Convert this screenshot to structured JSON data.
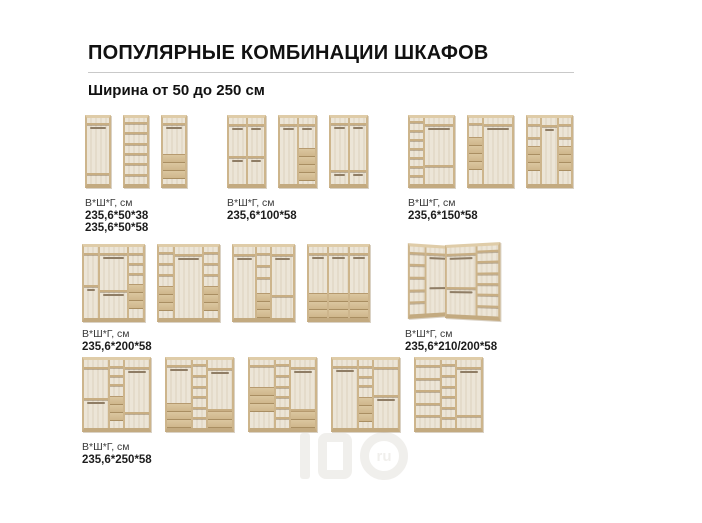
{
  "page": {
    "title": "ПОПУЛЯРНЫЕ КОМБИНАЦИИ ШКАФОВ",
    "subtitle": "Ширина от 50 до 250 см"
  },
  "dims_label": "В*Ш*Г, см",
  "watermark": {
    "circle_label": "ru"
  },
  "colors": {
    "wood_frame": "#cdb58c",
    "wood_top": "#dfcca8",
    "wood_plinth": "#c3aa80",
    "interior": "#ece5d7",
    "shelf": "#c8ae83",
    "rod": "#8f7d65",
    "drawer": "#d5bf97",
    "text": "#1d1d1d",
    "rule": "#c9c9c9"
  },
  "groups": [
    {
      "key": "width-50",
      "dims": [
        "235,6*50*38",
        "235,6*50*58"
      ],
      "wardrobes": [
        {
          "w": 26,
          "h": 73,
          "cols": [
            {
              "f": 1,
              "items": [
                "o:0.35",
                "s",
                "r",
                "o:3",
                "s",
                "o:0.6"
              ]
            }
          ]
        },
        {
          "w": 26,
          "h": 73,
          "cols": [
            {
              "f": 1,
              "items": [
                "sh:6"
              ]
            }
          ]
        },
        {
          "w": 26,
          "h": 73,
          "cols": [
            {
              "f": 1,
              "items": [
                "o:0.35",
                "s",
                "r",
                "o:2",
                "d:3",
                "o:0.35"
              ]
            }
          ]
        }
      ]
    },
    {
      "key": "width-100",
      "dims": [
        "235,6*100*58"
      ],
      "wardrobes": [
        {
          "w": 39,
          "h": 73,
          "cols": [
            {
              "f": 1,
              "items": [
                "o:0.35",
                "s",
                "r",
                "o:1.6",
                "s",
                "r",
                "o:1.3"
              ]
            },
            {
              "f": 1,
              "items": [
                "o:0.35",
                "s",
                "r",
                "o:1.6",
                "s",
                "r",
                "o:1.3"
              ]
            }
          ]
        },
        {
          "w": 39,
          "h": 73,
          "cols": [
            {
              "f": 1,
              "items": [
                "o:0.35",
                "s",
                "r",
                "o:3"
              ]
            },
            {
              "f": 1,
              "items": [
                "o:0.35",
                "s",
                "r",
                "o:1",
                "d:4",
                "o:0.2"
              ]
            }
          ]
        },
        {
          "w": 39,
          "h": 73,
          "cols": [
            {
              "f": 1,
              "items": [
                "o:0.35",
                "s",
                "r",
                "o:2.6",
                "s",
                "r",
                "o:0.5"
              ]
            },
            {
              "f": 1,
              "items": [
                "o:0.35",
                "s",
                "r",
                "o:2.6",
                "s",
                "r",
                "o:0.5"
              ]
            }
          ]
        }
      ]
    },
    {
      "key": "width-150",
      "dims": [
        "235,6*150*58"
      ],
      "wardrobes": [
        {
          "w": 47,
          "h": 73,
          "cols": [
            {
              "f": 1,
              "items": [
                "sh:7"
              ]
            },
            {
              "f": 2.1,
              "items": [
                "o:0.35",
                "s",
                "r",
                "o:2",
                "s",
                "o:1"
              ]
            }
          ]
        },
        {
          "w": 47,
          "h": 73,
          "cols": [
            {
              "f": 1,
              "items": [
                "o:0.35",
                "s",
                "o:0.8",
                "d:4",
                "o:1"
              ]
            },
            {
              "f": 2.1,
              "items": [
                "o:0.35",
                "s",
                "r",
                "o:3"
              ]
            }
          ]
        },
        {
          "w": 47,
          "h": 73,
          "cols": [
            {
              "f": 1,
              "items": [
                "o:0.3",
                "s",
                "o:0.6",
                "s",
                "o:0.4",
                "d:3",
                "o:0.7"
              ]
            },
            {
              "f": 1.15,
              "items": [
                "o:0.35",
                "s",
                "r",
                "o:2.6"
              ]
            },
            {
              "f": 1,
              "items": [
                "o:0.3",
                "s",
                "o:0.6",
                "s",
                "o:0.4",
                "d:3",
                "o:0.7"
              ]
            }
          ]
        }
      ]
    },
    {
      "key": "width-200",
      "dims": [
        "235,6*200*58"
      ],
      "wardrobes": [
        {
          "w": 63,
          "h": 78,
          "cols": [
            {
              "f": 1,
              "items": [
                "o:0.3",
                "s",
                "o:1.4",
                "s",
                "r",
                "o:1.3"
              ]
            },
            {
              "f": 2,
              "items": [
                "o:0.3",
                "s",
                "r",
                "o:1.5",
                "s",
                "r",
                "o:1.1"
              ]
            },
            {
              "f": 1,
              "items": [
                "o:0.3",
                "s",
                "o:0.45",
                "s",
                "o:0.45",
                "s",
                "o:0.45",
                "d:3",
                "o:0.5"
              ]
            }
          ]
        },
        {
          "w": 63,
          "h": 78,
          "cols": [
            {
              "f": 1,
              "items": [
                "o:0.3",
                "s",
                "o:0.5",
                "s",
                "o:0.5",
                "s",
                "o:0.6",
                "d:3",
                "o:0.4"
              ]
            },
            {
              "f": 2,
              "items": [
                "o:0.3",
                "s",
                "r",
                "o:2.4"
              ]
            },
            {
              "f": 1,
              "items": [
                "o:0.3",
                "s",
                "o:0.5",
                "s",
                "o:0.5",
                "s",
                "o:0.6",
                "d:3",
                "o:0.4"
              ]
            }
          ]
        },
        {
          "w": 63,
          "h": 78,
          "cols": [
            {
              "f": 1.6,
              "items": [
                "o:0.3",
                "s",
                "r",
                "o:2.5"
              ]
            },
            {
              "f": 1,
              "items": [
                "o:0.3",
                "s",
                "o:0.5",
                "s",
                "o:0.5",
                "s",
                "o:0.7",
                "d:3"
              ]
            },
            {
              "f": 1.6,
              "items": [
                "o:0.3",
                "s",
                "r",
                "o:1.5",
                "s",
                "o:0.9"
              ]
            }
          ]
        },
        {
          "w": 63,
          "h": 78,
          "cols": [
            {
              "f": 1,
              "items": [
                "o:0.3",
                "s",
                "r",
                "o:1.8",
                "d:3"
              ]
            },
            {
              "f": 1,
              "items": [
                "o:0.3",
                "s",
                "r",
                "o:1.8",
                "d:3"
              ]
            },
            {
              "f": 1,
              "items": [
                "o:0.3",
                "s",
                "r",
                "o:1.8",
                "d:3"
              ]
            }
          ]
        }
      ]
    },
    {
      "key": "width-210-200-corner",
      "dims": [
        "235,6*210/200*58"
      ],
      "corner_wings": [
        {
          "w": 46,
          "h": 70,
          "cols": [
            {
              "f": 1,
              "items": [
                "sh:5"
              ]
            },
            {
              "f": 1.6,
              "items": [
                "o:0.3",
                "s",
                "r",
                "o:1.5",
                "r",
                "o:1.4"
              ]
            }
          ]
        },
        {
          "w": 56,
          "h": 73,
          "cols": [
            {
              "f": 1.5,
              "items": [
                "o:0.3",
                "s",
                "r",
                "o:1.3",
                "s",
                "r",
                "o:1"
              ]
            },
            {
              "f": 1,
              "items": [
                "sh:6"
              ]
            }
          ]
        }
      ]
    },
    {
      "key": "width-250",
      "dims": [
        "235,6*250*58"
      ],
      "wardrobes": [
        {
          "w": 69,
          "h": 75,
          "cols": [
            {
              "f": 1.8,
              "items": [
                "o:0.3",
                "s",
                "o:1.3",
                "s",
                "r",
                "o:1.1"
              ]
            },
            {
              "f": 1,
              "items": [
                "o:0.3",
                "s",
                "o:0.4",
                "s",
                "o:0.4",
                "s",
                "o:0.5",
                "d:3",
                "o:0.4"
              ]
            },
            {
              "f": 1.8,
              "items": [
                "o:0.3",
                "s",
                "r",
                "o:1.7",
                "s",
                "o:0.6"
              ]
            }
          ]
        },
        {
          "w": 69,
          "h": 75,
          "cols": [
            {
              "f": 1.8,
              "items": [
                "o:0.3",
                "s",
                "r",
                "o:1.8",
                "d:3"
              ]
            },
            {
              "f": 1,
              "items": [
                "sh:6"
              ]
            },
            {
              "f": 1.8,
              "items": [
                "o:0.3",
                "s",
                "r",
                "o:1.3",
                "s",
                "d:2"
              ]
            }
          ]
        },
        {
          "w": 69,
          "h": 75,
          "cols": [
            {
              "f": 1.8,
              "items": [
                "o:0.3",
                "s",
                "o:1.1",
                "d:3",
                "o:0.9"
              ]
            },
            {
              "f": 1,
              "items": [
                "sh:6"
              ]
            },
            {
              "f": 1.8,
              "items": [
                "o:0.3",
                "s",
                "r",
                "o:1.5",
                "s",
                "d:2"
              ]
            }
          ]
        },
        {
          "w": 69,
          "h": 75,
          "cols": [
            {
              "f": 1.8,
              "items": [
                "o:0.3",
                "s",
                "r",
                "o:2.6"
              ]
            },
            {
              "f": 1,
              "items": [
                "o:0.3",
                "s",
                "o:0.4",
                "s",
                "o:0.4",
                "s",
                "o:0.5",
                "d:3",
                "o:0.3"
              ]
            },
            {
              "f": 1.8,
              "items": [
                "o:0.3",
                "s",
                "o:1.2",
                "s",
                "r",
                "o:1.2"
              ]
            }
          ]
        },
        {
          "w": 69,
          "h": 75,
          "cols": [
            {
              "f": 1.8,
              "items": [
                "sh:5"
              ]
            },
            {
              "f": 1,
              "items": [
                "sh:6"
              ]
            },
            {
              "f": 1.8,
              "items": [
                "o:0.3",
                "s",
                "r",
                "o:1.9",
                "s",
                "o:0.5"
              ]
            }
          ]
        }
      ]
    }
  ]
}
